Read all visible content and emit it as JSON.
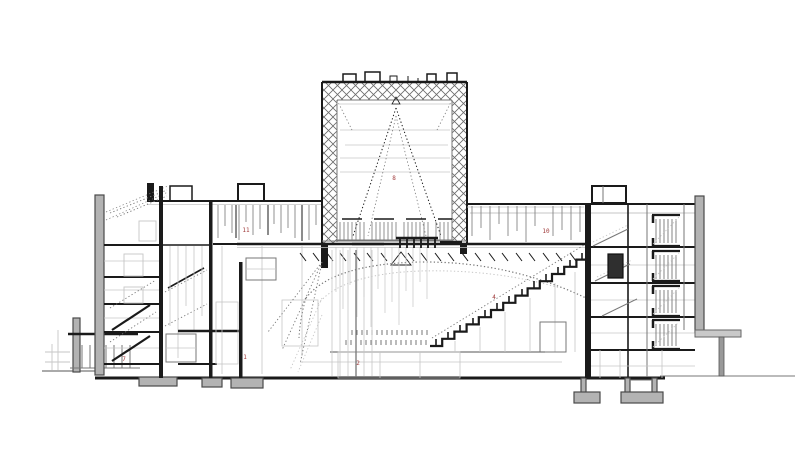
{
  "colors": {
    "background": "#ffffff",
    "line_dark": "#1a1a1a",
    "line_mid": "#777777",
    "line_light": "#c6c6c6",
    "wall_gray": "#b3b3b3",
    "label_red": "#a03b3b"
  },
  "labels": [
    {
      "text": "7"
    },
    {
      "text": "1"
    },
    {
      "text": "2"
    },
    {
      "text": "8"
    },
    {
      "text": "11"
    },
    {
      "text": "10"
    },
    {
      "text": "4"
    }
  ]
}
